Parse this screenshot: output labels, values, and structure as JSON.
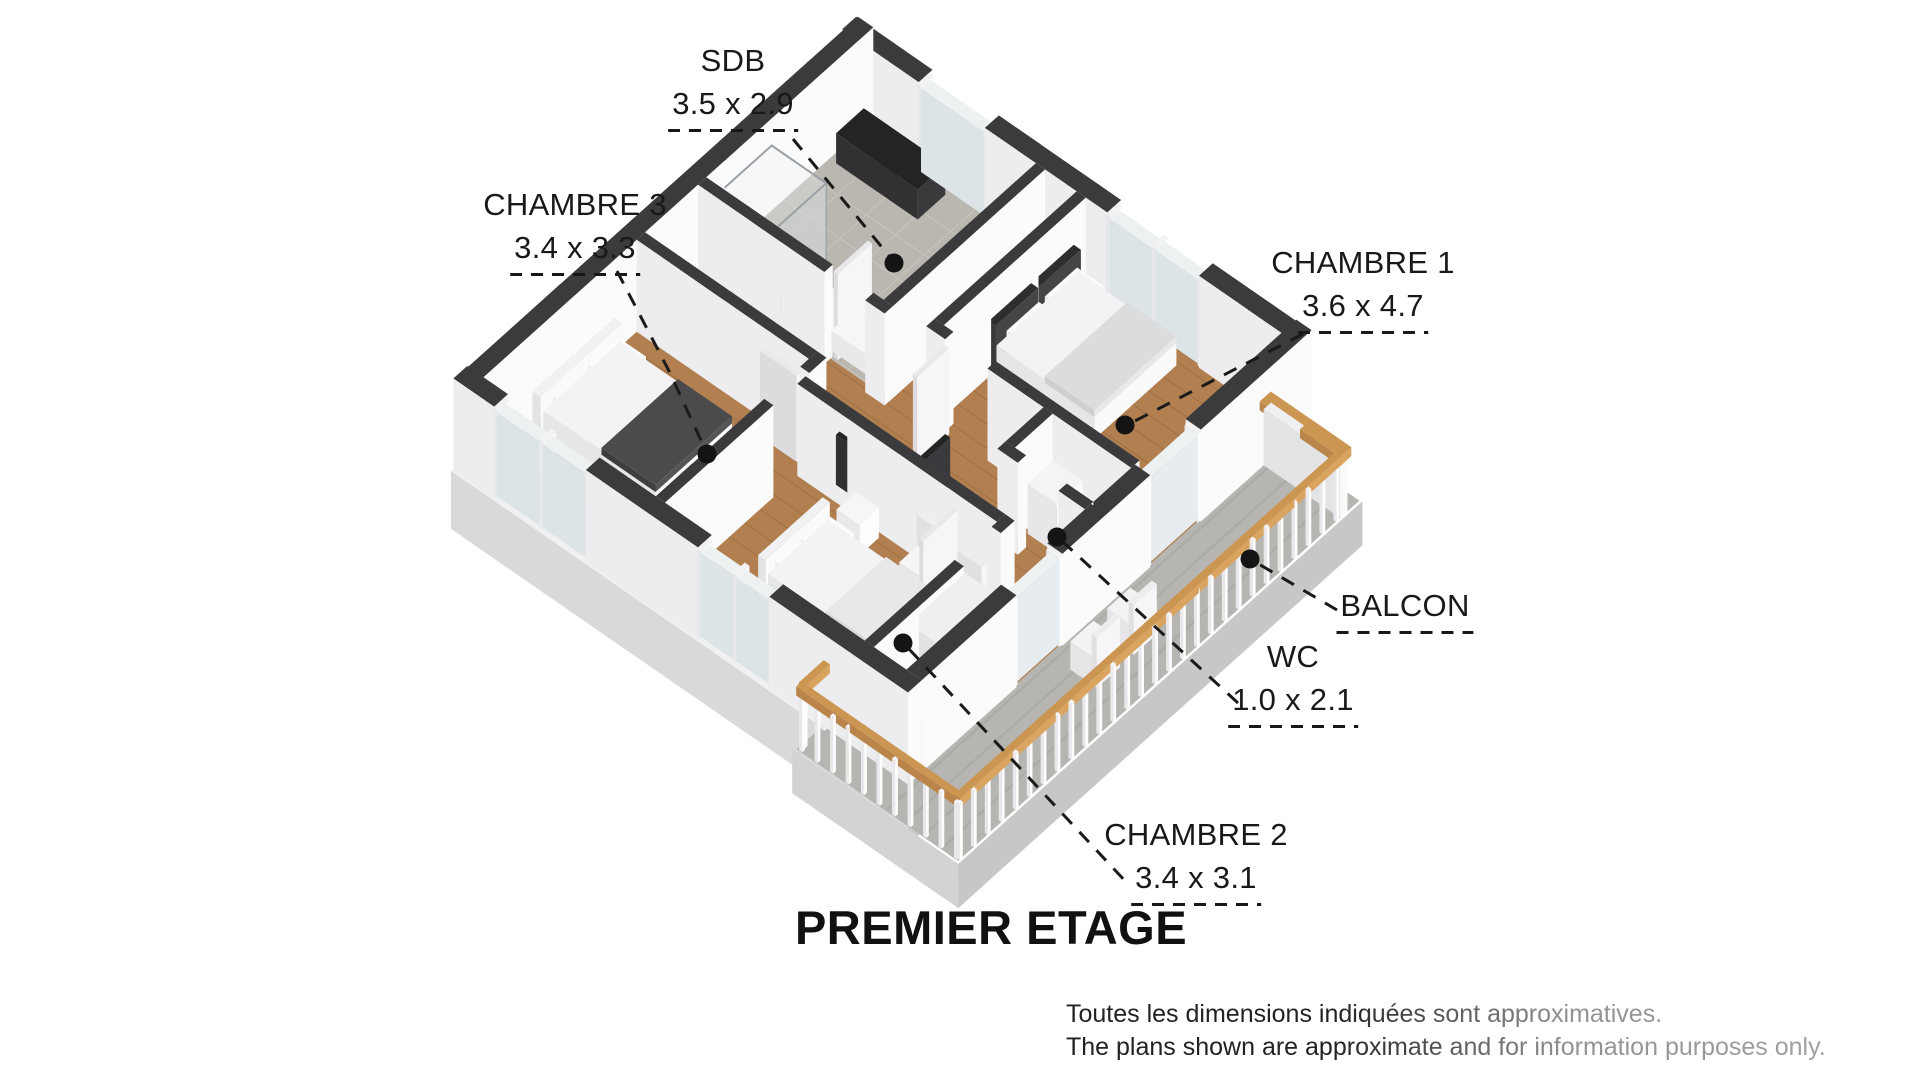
{
  "title": "PREMIER ETAGE",
  "disclaimer": {
    "line1": "Toutes les dimensions indiquées sont approximatives.",
    "line2": "The plans shown are approximate and for information purposes only."
  },
  "rooms": [
    {
      "name": "SDB",
      "dims": "3.5 x 2.9"
    },
    {
      "name": "CHAMBRE 3",
      "dims": "3.4 x 3.3"
    },
    {
      "name": "CHAMBRE 1",
      "dims": "3.6 x 4.7"
    },
    {
      "name": "BALCON",
      "dims": ""
    },
    {
      "name": "WC",
      "dims": "1.0 x 2.1"
    },
    {
      "name": "CHAMBRE 2",
      "dims": "3.4 x 3.1"
    }
  ],
  "colors": {
    "wallTop": "#3b3b3d",
    "wallFaceL": "#ededf0",
    "wallFaceR": "#fbfbfc",
    "wood": "#b28050",
    "woodLine": "rgba(97,63,28,0.25)",
    "tile": "#bab6b0",
    "grout": "#c8c4be",
    "concrete": "#b7b5b1",
    "concreteLine": "rgba(0,0,0,0.05)",
    "slabL": "#d9d9db",
    "slabR": "#c9c9cc",
    "slabTop": "#f0f0f1",
    "glass": "#dce4e8",
    "glassTop": "#eef1f2",
    "rail": "#b9854a",
    "railTop": "#cb9552",
    "railLight": "#d8a45f",
    "leader": "#1a1a1a",
    "dot": "#141414",
    "text": "#191919",
    "dark": "#3f3f42",
    "void": "#707073"
  }
}
